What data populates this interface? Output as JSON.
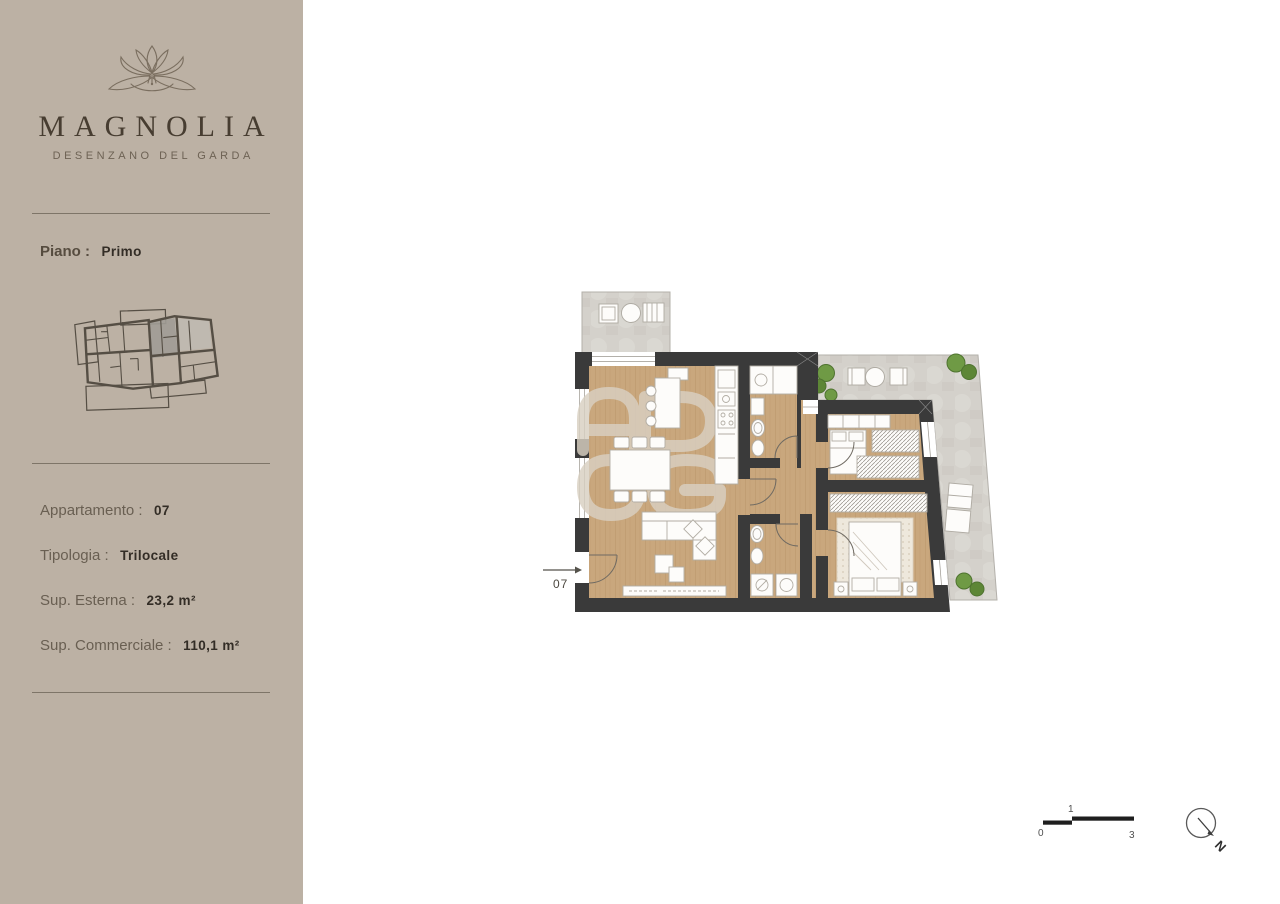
{
  "page": {
    "background": "#ffffff"
  },
  "sidebar": {
    "background": "#bcb1a4",
    "brand": {
      "logo_icon": "magnolia-flower-line-art",
      "name": "MAGNOLIA",
      "subtitle": "DESENZANO DEL GARDA"
    },
    "floor": {
      "label": "Piano :",
      "value": "Primo"
    },
    "mini_plan_icon": "building-overview-highlighted-unit",
    "details": [
      {
        "label": "Appartamento :",
        "value": "07"
      },
      {
        "label": "Tipologia :",
        "value": "Trilocale"
      },
      {
        "label": "Sup. Esterna :",
        "value": "23,2 m²"
      },
      {
        "label": "Sup. Commerciale :",
        "value": "110,1 m²"
      }
    ]
  },
  "floorplan": {
    "unit_label": "07",
    "watermark": "ADOG",
    "colors": {
      "walls": "#3a3a3a",
      "wood_floor": "#c9a77d",
      "terrace": "#d4d1cb",
      "plants": "#6f9a45",
      "fixtures": "#fdfcfa",
      "watermark": "#d9d0c2"
    }
  },
  "scale_bar": {
    "start": "0",
    "mid": "1",
    "end": "3"
  },
  "compass": {
    "north_label": "N"
  }
}
